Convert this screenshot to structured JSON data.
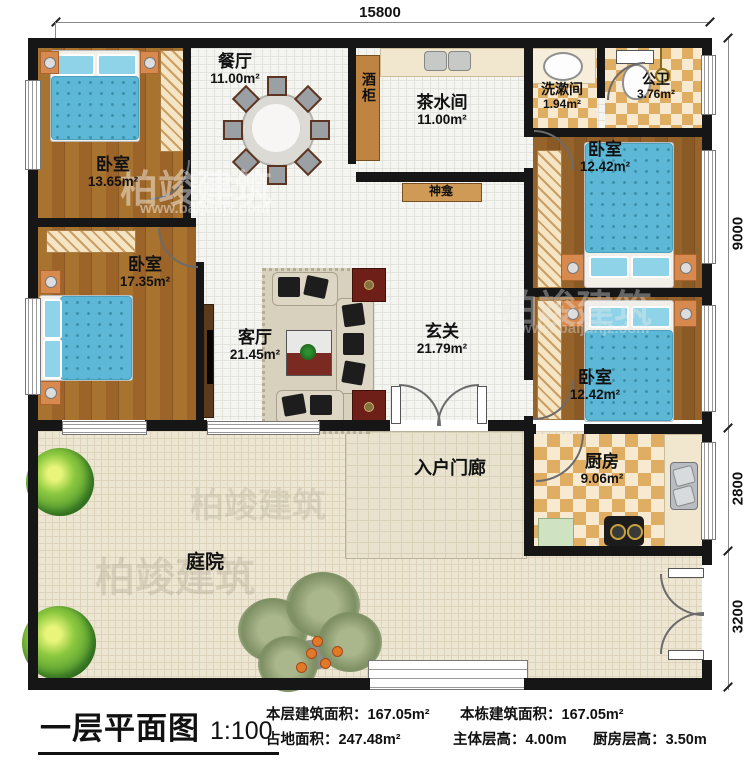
{
  "legend": {
    "title": "一层平面图",
    "scale": "1:100",
    "line1": [
      {
        "label": "本层建筑面积：",
        "value": "167.05m²"
      },
      {
        "label": "本栋建筑面积：",
        "value": "167.05m²"
      }
    ],
    "line2": [
      {
        "label": "占地面积：",
        "value": "247.48m²"
      },
      {
        "label": "主体层高：",
        "value": "4.00m"
      },
      {
        "label": "厨房层高：",
        "value": "3.50m"
      }
    ]
  },
  "dimensions": {
    "top": "15800",
    "right_upper": "9000",
    "right_mid": "2800",
    "right_lower": "3200"
  },
  "rooms": {
    "bedroom_tl": {
      "name": "卧室",
      "area": "13.65m²"
    },
    "bedroom_left": {
      "name": "卧室",
      "area": "17.35m²"
    },
    "dining": {
      "name": "餐厅",
      "area": "11.00m²"
    },
    "tea": {
      "name": "茶水间",
      "area": "11.00m²"
    },
    "wash": {
      "name": "洗漱间",
      "area": "1.94m²"
    },
    "bath": {
      "name": "公卫",
      "area": "3.76m²"
    },
    "bedroom_tr": {
      "name": "卧室",
      "area": "12.42m²"
    },
    "bedroom_r": {
      "name": "卧室",
      "area": "12.42m²"
    },
    "living": {
      "name": "客厅",
      "area": "21.45m²"
    },
    "foyer": {
      "name": "玄关",
      "area": "21.79m²"
    },
    "kitchen": {
      "name": "厨房",
      "area": "9.06m²"
    },
    "porch": {
      "name": "入户门廊"
    },
    "courtyard": {
      "name": "庭院"
    }
  },
  "fixtures": {
    "wine_cabinet": "酒柜",
    "shrine": "神龛"
  },
  "watermark": {
    "brand": "柏竣建筑",
    "url": "www.baijunjz.com"
  },
  "colors": {
    "wall": "#161616",
    "wood": "#a8722f",
    "bed_blue": "#5cb8d6",
    "checker_tan": "#e0ae63",
    "courtyard": "#ede6d3",
    "accent_red": "#6e2018"
  }
}
